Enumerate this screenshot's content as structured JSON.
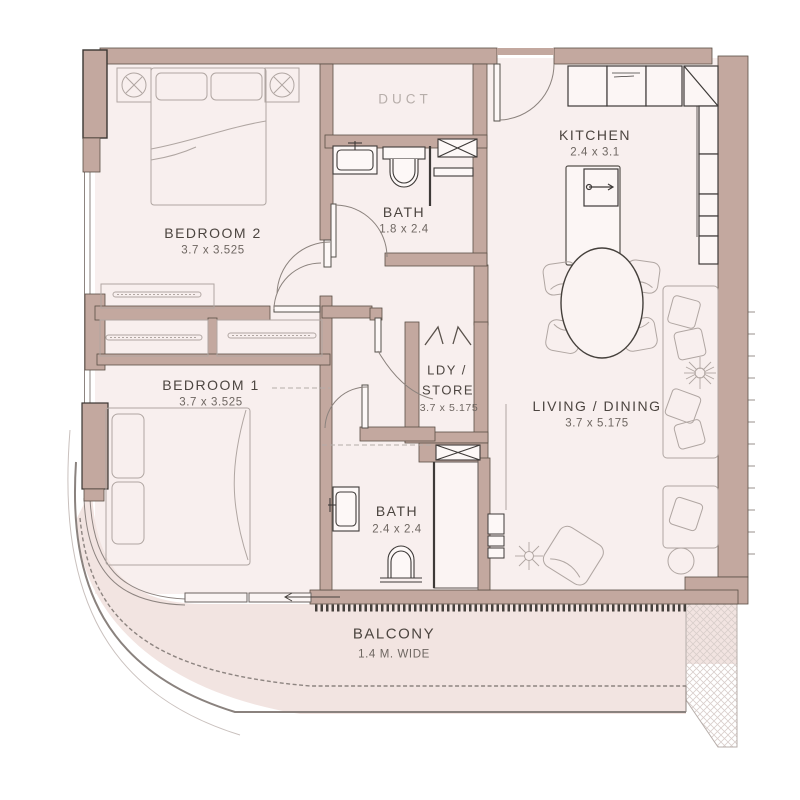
{
  "floorplan": {
    "rooms": {
      "bedroom2": {
        "name": "BEDROOM 2",
        "dims": "3.7 x 3.525"
      },
      "bedroom1": {
        "name": "BEDROOM 1",
        "dims": "3.7 x 3.525"
      },
      "duct": {
        "name": "DUCT"
      },
      "bath1": {
        "name": "BATH",
        "dims": "1.8 x 2.4"
      },
      "bath2": {
        "name": "BATH",
        "dims": "2.4 x 2.4"
      },
      "kitchen": {
        "name": "KITCHEN",
        "dims": "2.4 x 3.1"
      },
      "ldy": {
        "name_line1": "LDY /",
        "name_line2": "STORE",
        "dims": "3.7 x 5.175"
      },
      "living": {
        "name": "LIVING / DINING",
        "dims": "3.7 x 5.175"
      },
      "balcony": {
        "name": "BALCONY",
        "dims": "1.4 M. WIDE"
      }
    },
    "colors": {
      "wall": "#c3a89f",
      "floor": "#f8efee",
      "balcony_floor": "#f2e4e1",
      "fixture_line": "#3e3a38",
      "furniture_line": "#b0a6a2",
      "room_text": "#4c4540",
      "dim_text": "#6e6661",
      "duct_text": "#b7aeaa"
    }
  }
}
